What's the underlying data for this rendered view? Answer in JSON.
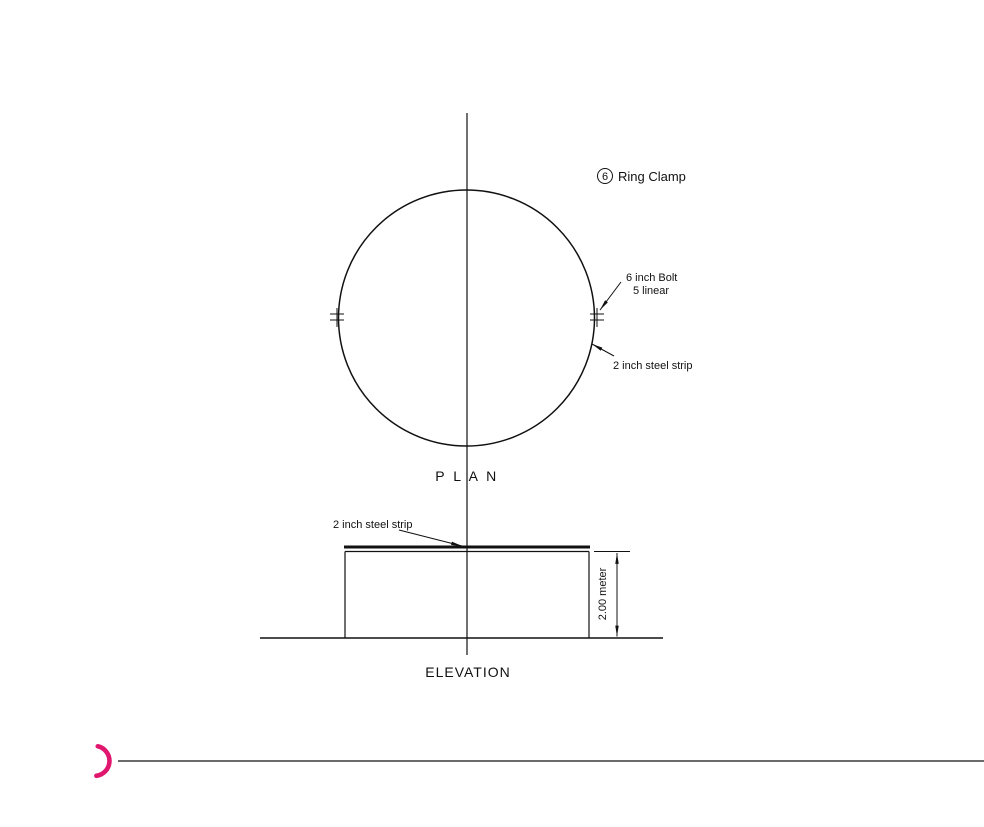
{
  "colors": {
    "line": "#111111",
    "accent_pink": "#e0176e",
    "background": "#ffffff"
  },
  "callout": {
    "number": "6",
    "label": "Ring Clamp"
  },
  "plan_view": {
    "title": "P L A N",
    "bolt_label_line1": "6 inch Bolt",
    "bolt_label_line2": "5 linear",
    "strip_label": "2 inch steel strip"
  },
  "elevation_view": {
    "title": "ELEVATION",
    "strip_label": "2 inch steel strip",
    "height_dimension": "2.00 meter"
  }
}
